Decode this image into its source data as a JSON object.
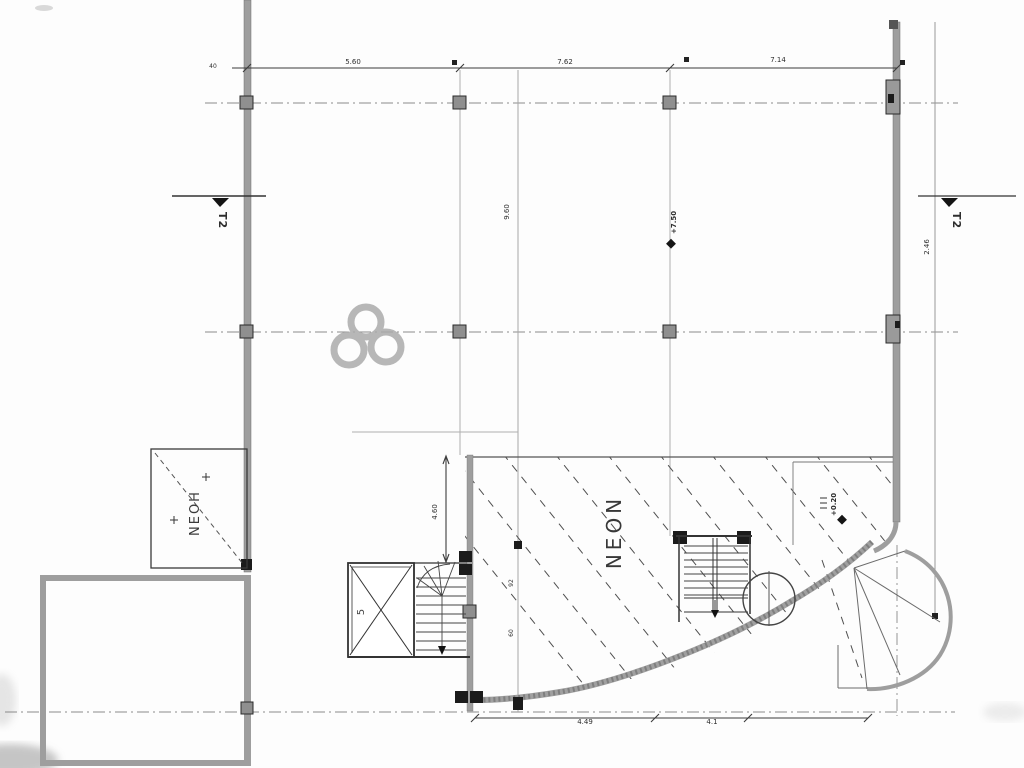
{
  "drawing": {
    "type": "scanned architectural floor plan",
    "section_markers": {
      "left": "T2",
      "right": "T2"
    },
    "zones": {
      "left_box": "ΝΕΟΗ",
      "main_area": "ΝΕΟΝ"
    },
    "rooms": {
      "shaft_label": "5"
    },
    "levels": {
      "mid_marker": "+7.50",
      "right_marker": "+0.20"
    },
    "dimensions": {
      "top_spans": [
        "5.60",
        "7.62",
        "7.14"
      ],
      "top_left_tick": "40",
      "bottom_spans": [
        "4.49",
        "4.1"
      ],
      "stair_vertical": "4.60",
      "grid_vertical_mid": "9.60",
      "right_edge_vertical": "2.46",
      "hatch_upper": "92",
      "hatch_lower": "60"
    },
    "colors": {
      "wall_gray": "#9e9e9e",
      "line_dark": "#3c3c3c",
      "watermark_gray": "#ababab",
      "background": "#fdfdfd"
    }
  }
}
